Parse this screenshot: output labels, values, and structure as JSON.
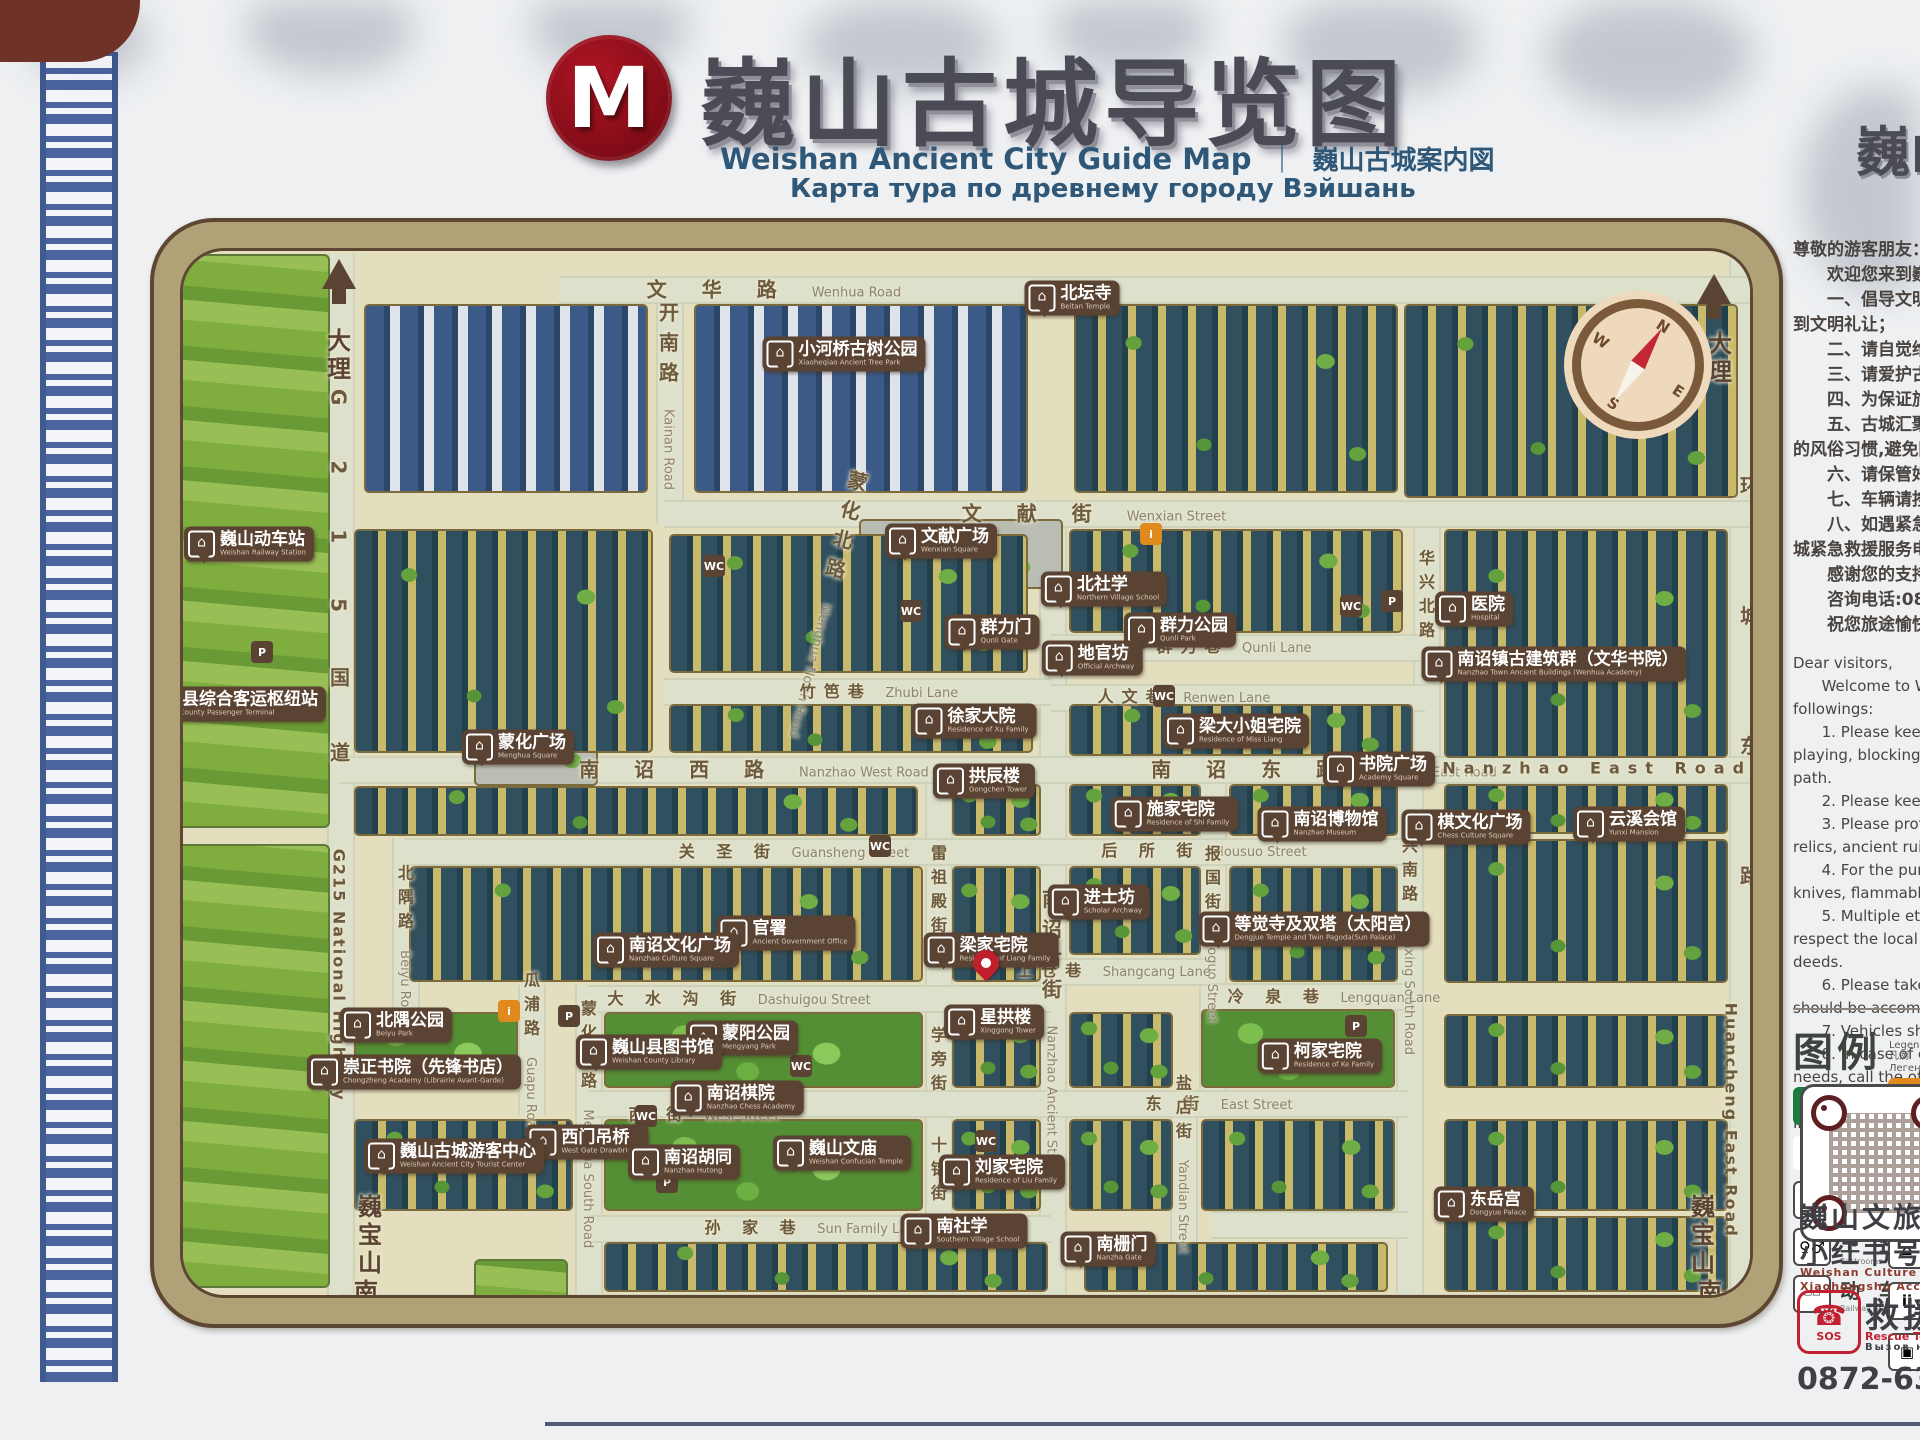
{
  "sign": {
    "logo_letter": "M",
    "title_zh": "巍山古城导览图",
    "title_en": "Weishan Ancient City Guide Map",
    "divider": "｜",
    "title_jp": "巍山古城案内図",
    "title_ru": "Карта тура по древнему городу Вэйшань",
    "title_right_partial": "巍山"
  },
  "notice_zh": {
    "lines": [
      "尊敬的游客朋友：",
      "　　欢迎您来到巍山古城",
      "　　一、倡导文明游览，",
      "到文明礼让；",
      "　　二、请自觉维护古城",
      "　　三、请爱护古城内的",
      "　　四、为保证旅客安全",
      "　　五、古城汇聚了多民",
      "的风俗习惯,避免因言行举",
      "　　六、请保管好随身携",
      "　　七、车辆请按规定的",
      "　　八、如遇紧急状况请",
      "城紧急救援服务电话,我们",
      "　　感谢您的支持与配合",
      "　　咨询电话:0872—63",
      "　　祝您旅途愉快！"
    ]
  },
  "notice_en": {
    "lines": [
      "Dear visitors,",
      "      Welcome to Weishan A",
      "followings:",
      "      1. Please keep good ",
      "playing, blocking roads and",
      "path.",
      "      2. Please keep the envi",
      "      3. Please protect the re",
      "relics, ancient ruins and anc",
      "      4. For the purpose of sa",
      "knives, flammable and explo",
      "      5. Multiple ethnic cultu",
      "respect the local customs d",
      "deeds.",
      "      6. Please take good car",
      "should be accompanied with",
      "      7. Vehicles should trave",
      "      8. In case of emergency",
      "needs, call the official emerg",
      "      Thank you for your supp",
      "Inquiry Hotline: 0872—63690",
      "Emergency Rescue Hotline: 0",
      "      Enjoy your trip!"
    ]
  },
  "legend": {
    "title_zh": "图例",
    "title_en": "Legend",
    "title_jp": "凡例",
    "title_ru": "Легенда",
    "items": [
      {
        "icon": "medical",
        "zh": "医 疗 点",
        "en": "Medical Service"
      },
      {
        "icon": "pin",
        "zh": "您的位置",
        "en": "You are here"
      },
      {
        "icon": "parking",
        "zh": "停 车 场",
        "en": "Parking lot"
      },
      {
        "icon": "toilet",
        "zh": "卫 生 间",
        "en": "Restrooms"
      },
      {
        "icon": "train",
        "zh": "动 车 站",
        "en": "Railway Station"
      }
    ],
    "right_icons": [
      "info",
      "wheelchair",
      "photo",
      "hotel",
      "guide",
      "luggage"
    ]
  },
  "footer": {
    "qr_zh1": "巍山文旅",
    "qr_zh2": "小红书号",
    "qr_en1": "Weishan Culture & Tourism",
    "qr_en2": "Xiaohongshu Account",
    "rescue_zh": "救援电话",
    "rescue_en": "Rescue Tel ｜ 救援",
    "rescue_ru": "Вызов на помощь",
    "sos": "SOS",
    "phone_glyph": "☎",
    "phone": "0872-635293"
  },
  "map": {
    "compass": {
      "n": "N",
      "e": "E",
      "s": "S",
      "w": "W"
    },
    "directions": [
      {
        "t": "大理",
        "x": 333,
        "y": 352,
        "cls": "v dir"
      },
      {
        "t": "大理",
        "x": 1714,
        "y": 355,
        "cls": "v dir"
      },
      {
        "t": "巍宝山",
        "x": 364,
        "y": 1232,
        "cls": "v dir small"
      },
      {
        "t": "南涧",
        "x": 360,
        "y": 1303,
        "cls": "v dir small"
      },
      {
        "t": "巍宝山",
        "x": 1697,
        "y": 1232,
        "cls": "v dir small"
      },
      {
        "t": "南涧",
        "x": 1704,
        "y": 1303,
        "cls": "v dir small"
      }
    ],
    "roads": [
      {
        "zh": "文 华 路",
        "en": "Wenhua Road",
        "x": 770,
        "y": 284
      },
      {
        "zh": "开南路",
        "en": "Kainan Road",
        "x": 664,
        "y": 392,
        "cls": "v"
      },
      {
        "zh": "文 献 街",
        "en": "Wenxian Street",
        "x": 1090,
        "y": 508
      },
      {
        "zh": "蒙化北路",
        "en": "Menghua North Road",
        "x": 822,
        "y": 600,
        "cls": "v",
        "rot": 14
      },
      {
        "zh": "竹笆巷",
        "en": "Zhubi Lane",
        "x": 875,
        "y": 686,
        "cls": "small"
      },
      {
        "zh": "群力巷",
        "en": "Qunli Lane",
        "x": 1230,
        "y": 641,
        "cls": "small"
      },
      {
        "zh": "人文巷",
        "en": "Renwen Lane",
        "x": 1180,
        "y": 691,
        "cls": "small"
      },
      {
        "zh": "华兴北路",
        "en": "",
        "x": 1421,
        "y": 600,
        "cls": "v small"
      },
      {
        "zh": "华兴南路",
        "en": "Huaxing South Road",
        "x": 1404,
        "y": 930,
        "cls": "v small"
      },
      {
        "zh": "南 诏 西 路",
        "en": "Nanzhao West Road",
        "x": 750,
        "y": 764
      },
      {
        "zh": "南 诏 东 路",
        "en": "Nanzhao East Road",
        "x": 1320,
        "y": 764
      },
      {
        "zh": "Nanzhao East Road",
        "en": "",
        "x": 1600,
        "y": 764,
        "cls": "small"
      },
      {
        "zh": "南诏古街",
        "en": "Nanzhao Ancient Street",
        "x": 1047,
        "y": 1030,
        "cls": "v"
      },
      {
        "zh": "关 圣 街",
        "en": "Guansheng Street",
        "x": 790,
        "y": 846,
        "cls": "small"
      },
      {
        "zh": "后 所 街",
        "en": "Housuo Street",
        "x": 1200,
        "y": 845,
        "cls": "small"
      },
      {
        "zh": "报国街",
        "en": "Baoguo Street",
        "x": 1207,
        "y": 930,
        "cls": "v small"
      },
      {
        "zh": "雷祖殿街",
        "en": "",
        "x": 933,
        "y": 895,
        "cls": "v small"
      },
      {
        "zh": "学旁街",
        "en": "",
        "x": 933,
        "y": 1065,
        "cls": "v small"
      },
      {
        "zh": "十锦街",
        "en": "",
        "x": 933,
        "y": 1175,
        "cls": "v small"
      },
      {
        "zh": "大 水 沟 街",
        "en": "Dashuigou Street",
        "x": 735,
        "y": 993,
        "cls": "small"
      },
      {
        "zh": "西 街",
        "en": "West Street",
        "x": 700,
        "y": 1109,
        "cls": "small"
      },
      {
        "zh": "东 街",
        "en": "East Street",
        "x": 1215,
        "y": 1098,
        "cls": "small"
      },
      {
        "zh": "孙 家 巷",
        "en": "Sun Family Lane",
        "x": 810,
        "y": 1222,
        "cls": "small"
      },
      {
        "zh": "上仓巷",
        "en": "Shangcang Lane",
        "x": 1110,
        "y": 965,
        "cls": "small"
      },
      {
        "zh": "冷 泉 巷",
        "en": "Lengquan Lane",
        "x": 1330,
        "y": 991,
        "cls": "small"
      },
      {
        "zh": "盐店街",
        "en": "Yandian Street",
        "x": 1178,
        "y": 1160,
        "cls": "v small"
      },
      {
        "zh": "瓜浦路",
        "en": "Guapu Road",
        "x": 526,
        "y": 1050,
        "cls": "v small"
      },
      {
        "zh": "北隅路",
        "en": "Beiyu Road",
        "x": 400,
        "y": 940,
        "cls": "v small"
      },
      {
        "zh": "蒙化南路",
        "en": "Menghua South Road",
        "x": 583,
        "y": 1120,
        "cls": "v small"
      },
      {
        "zh": "环  城  南  路",
        "en": "Huancheng South Road",
        "x": 1030,
        "y": 1303
      },
      {
        "zh": "环城东路",
        "en": "",
        "x": 1745,
        "y": 790,
        "cls": "v",
        "ls": 110
      },
      {
        "zh": "Huancheng East Road",
        "en": "",
        "x": 1727,
        "y": 1120,
        "cls": "v small",
        "ls": 2
      },
      {
        "zh": "G215国道",
        "en": "",
        "x": 335,
        "y": 630,
        "cls": "v",
        "ls": 55
      },
      {
        "zh": "G215 National Highway",
        "en": "",
        "x": 335,
        "y": 975,
        "cls": "v small",
        "ls": 2
      }
    ],
    "pois": [
      {
        "zh": "巍山动车站",
        "en": "Weishan Railway Station",
        "x": 245,
        "y": 540
      },
      {
        "zh": "巍山县综合客运枢纽站",
        "en": "Weishan County Passenger Terminal",
        "x": 215,
        "y": 700
      },
      {
        "zh": "小河桥古树公园",
        "en": "Xiaoheqiao Ancient Tree Park",
        "x": 840,
        "y": 350
      },
      {
        "zh": "北坛寺",
        "en": "Beitan Temple",
        "x": 1068,
        "y": 294
      },
      {
        "zh": "文献广场",
        "en": "Wenxian Square",
        "x": 937,
        "y": 537
      },
      {
        "zh": "北社学",
        "en": "Northern Village School",
        "x": 1100,
        "y": 585
      },
      {
        "zh": "群力门",
        "en": "Qunli Gate",
        "x": 988,
        "y": 628
      },
      {
        "zh": "群力公园",
        "en": "Qunli Park",
        "x": 1176,
        "y": 626
      },
      {
        "zh": "地官坊",
        "en": "Official Archway",
        "x": 1088,
        "y": 654
      },
      {
        "zh": "医院",
        "en": "Hospital",
        "x": 1470,
        "y": 605
      },
      {
        "zh": "南诏镇古建筑群（文华书院）",
        "en": "Nanzhao Town Ancient Buildings (Wenhua Academy)",
        "x": 1550,
        "y": 660
      },
      {
        "zh": "徐家大院",
        "en": "Residence of Xu Family",
        "x": 970,
        "y": 717
      },
      {
        "zh": "梁大小姐宅院",
        "en": "Residence of Miss Liang",
        "x": 1232,
        "y": 727
      },
      {
        "zh": "拱辰楼",
        "en": "Gongchen Tower",
        "x": 980,
        "y": 777
      },
      {
        "zh": "蒙化广场",
        "en": "Menghua Square",
        "x": 514,
        "y": 743
      },
      {
        "zh": "施家宅院",
        "en": "Residence of Shi Family",
        "x": 1170,
        "y": 810
      },
      {
        "zh": "南诏博物馆",
        "en": "Nanzhao Museum",
        "x": 1318,
        "y": 820
      },
      {
        "zh": "书院广场",
        "en": "Academy Square",
        "x": 1375,
        "y": 765
      },
      {
        "zh": "棋文化广场",
        "en": "Chess Culture Square",
        "x": 1462,
        "y": 823
      },
      {
        "zh": "云溪会馆",
        "en": "Yunxi Mansion",
        "x": 1625,
        "y": 820
      },
      {
        "zh": "进士坊",
        "en": "Scholar Archway",
        "x": 1095,
        "y": 898
      },
      {
        "zh": "等觉寺及双塔（太阳宫）",
        "en": "Dengjue Temple and Twin Pagoda(Sun Palace)",
        "x": 1310,
        "y": 925
      },
      {
        "zh": "梁家宅院",
        "en": "Residence of Liang Family",
        "x": 987,
        "y": 946
      },
      {
        "zh": "官署",
        "en": "Ancient Government Office",
        "x": 782,
        "y": 929
      },
      {
        "zh": "南诏文化广场",
        "en": "Nanzhao Culture Square",
        "x": 662,
        "y": 946
      },
      {
        "zh": "星拱楼",
        "en": "Xinggong Tower",
        "x": 990,
        "y": 1018
      },
      {
        "zh": "蒙阳公园",
        "en": "Mengyang Park",
        "x": 738,
        "y": 1034
      },
      {
        "zh": "巍山县图书馆",
        "en": "Weishan County Library",
        "x": 645,
        "y": 1048
      },
      {
        "zh": "南诏棋院",
        "en": "Nanzhao Chess Academy",
        "x": 733,
        "y": 1094
      },
      {
        "zh": "北隅公园",
        "en": "Beiyu Park",
        "x": 392,
        "y": 1021
      },
      {
        "zh": "崇正书院（先锋书店）",
        "en": "Chongzheng Academy (Librairie Avant-Garde)",
        "x": 410,
        "y": 1068
      },
      {
        "zh": "西门吊桥",
        "en": "West Gate Drawbridge",
        "x": 583,
        "y": 1138
      },
      {
        "zh": "巍山古城游客中心",
        "en": "Weishan Ancient City Tourist Center",
        "x": 450,
        "y": 1152
      },
      {
        "zh": "南诏胡同",
        "en": "Nanzhao Hutong",
        "x": 680,
        "y": 1158
      },
      {
        "zh": "巍山文庙",
        "en": "Weishan Confucian Temple",
        "x": 838,
        "y": 1149
      },
      {
        "zh": "刘家宅院",
        "en": "Residence of Liu Family",
        "x": 998,
        "y": 1168
      },
      {
        "zh": "柯家宅院",
        "en": "Residence of Ke Family",
        "x": 1316,
        "y": 1052
      },
      {
        "zh": "南社学",
        "en": "Southern Village School",
        "x": 960,
        "y": 1227
      },
      {
        "zh": "南栅门",
        "en": "Nanzha Gate",
        "x": 1104,
        "y": 1245
      },
      {
        "zh": "东岳宫",
        "en": "Dongyue Palace",
        "x": 1480,
        "y": 1200
      }
    ],
    "amenities": [
      {
        "g": "WC",
        "x": 710,
        "y": 562
      },
      {
        "g": "WC",
        "x": 907,
        "y": 607
      },
      {
        "g": "WC",
        "x": 1347,
        "y": 602
      },
      {
        "g": "WC",
        "x": 876,
        "y": 842
      },
      {
        "g": "WC",
        "x": 797,
        "y": 1062
      },
      {
        "g": "WC",
        "x": 982,
        "y": 1137
      },
      {
        "g": "WC",
        "x": 1337,
        "y": 922
      },
      {
        "g": "WC",
        "x": 642,
        "y": 1112
      },
      {
        "g": "WC",
        "x": 1160,
        "y": 692
      },
      {
        "g": "P",
        "x": 258,
        "y": 648
      },
      {
        "g": "P",
        "x": 565,
        "y": 1012
      },
      {
        "g": "P",
        "x": 1388,
        "y": 597
      },
      {
        "g": "P",
        "x": 1352,
        "y": 1022
      },
      {
        "g": "P",
        "x": 663,
        "y": 1178
      },
      {
        "g": "i",
        "x": 505,
        "y": 1007,
        "cls": "info"
      },
      {
        "g": "i",
        "x": 1147,
        "y": 530,
        "cls": "info"
      }
    ]
  }
}
